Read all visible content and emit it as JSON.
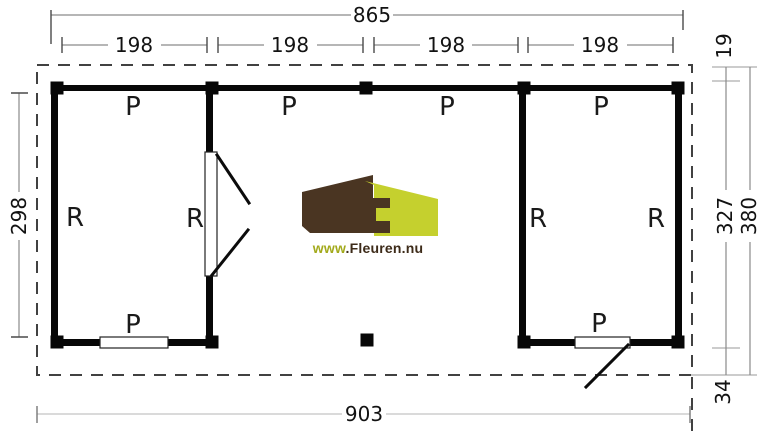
{
  "dimensions": {
    "top_total": "865",
    "bays": [
      "198",
      "198",
      "198",
      "198"
    ],
    "left_height": "298",
    "right_overhang_top": "19",
    "right_wall_height": "327",
    "right_total": "380",
    "right_overhang_bottom": "34",
    "bottom_total": "903"
  },
  "labels": {
    "p": "P",
    "r": "R"
  },
  "logo": {
    "prefix": "www",
    "suffix": ".Fleuren.nu"
  },
  "colors": {
    "wall": "#070707",
    "dashed_outline": "#414141",
    "dimension_line": "#8a8a8a",
    "dimension_line_light": "#c4c4c4",
    "text": "#121212",
    "logo_brown": "#4a3522",
    "logo_yellow": "#c5d02e",
    "logo_text_green": "#a3aa1c",
    "logo_text_brown": "#3d2b19"
  }
}
